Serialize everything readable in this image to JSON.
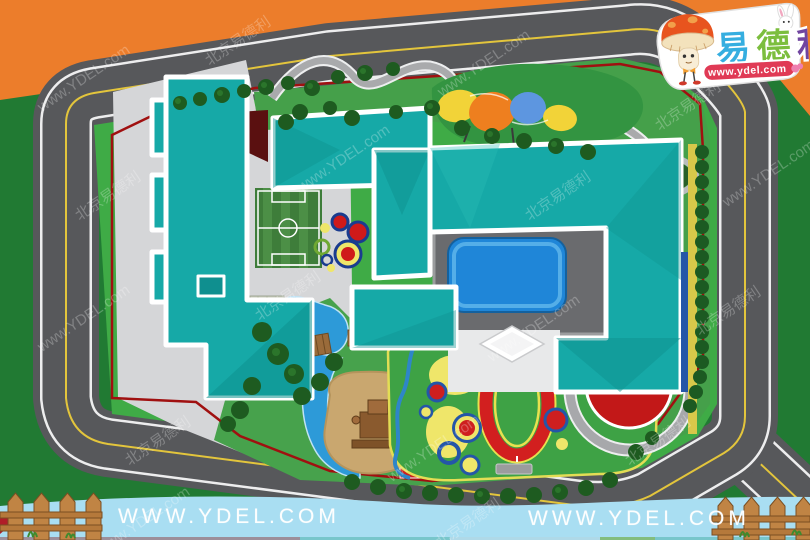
{
  "title": "kindergarten-site-plan-rendering",
  "logo": {
    "chars": [
      "易",
      "德",
      "利"
    ],
    "brand": "易德利",
    "url": "www.ydel.com"
  },
  "footer": {
    "left_url": "WWW.YDEL.COM",
    "right_url": "WWW.YDEL.COM"
  },
  "watermark": {
    "line1": "北京易德利",
    "line2": "www.YDEL.com"
  },
  "colors": {
    "frame_orange": "#EC7D2B",
    "building_teal": "#16A9A7",
    "road_gray": "#57585B",
    "pool_blue": "#1F86D8",
    "lawn_green": "#46A04B",
    "verge_green": "#3FAB46",
    "outer_grass_green": "#217A33",
    "paved_gray": "#D5D6D8",
    "sand_tan": "#C9A76F",
    "track_red": "#CE1F1F",
    "accent_yellow": "#EDE45D",
    "accent_navy": "#1C3F8F",
    "fence_red": "#A01010",
    "footer_blue": "#A9DEF2",
    "fence_wood": "#C08444"
  }
}
